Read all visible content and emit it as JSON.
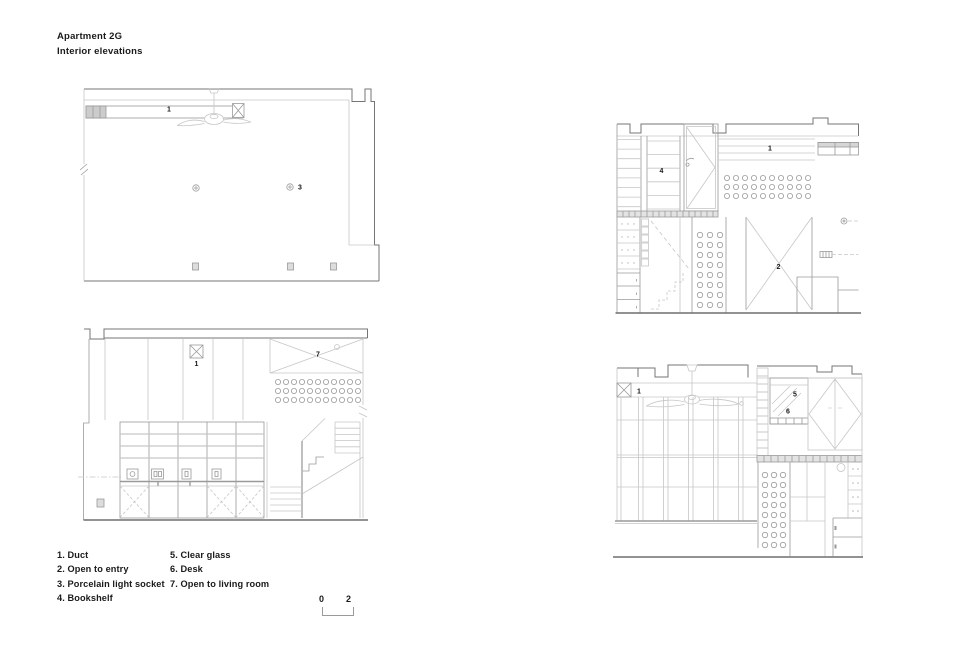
{
  "sheet": {
    "title": "Apartment 2G",
    "subtitle": "Interior elevations"
  },
  "legend": {
    "items": [
      "1. Duct",
      "2. Open to entry",
      "3. Porcelain light socket",
      "4. Bookshelf",
      "5. Clear glass",
      "6. Desk",
      "7. Open to living room"
    ]
  },
  "scale_bar": {
    "start": "0",
    "end": "2"
  },
  "drawings": {
    "top_left": {
      "labels": {
        "duct": "1",
        "light_socket": "3"
      }
    },
    "bottom_left": {
      "labels": {
        "duct": "1",
        "open_to_living_room": "7"
      }
    },
    "top_right": {
      "labels": {
        "bookshelf": "4",
        "duct": "1",
        "open_to_entry": "2"
      }
    },
    "bottom_right": {
      "labels": {
        "duct": "1",
        "clear_glass": "5",
        "desk": "6"
      }
    }
  },
  "colors": {
    "background": "#ffffff",
    "line_light": "#c6c6c6",
    "line_medium": "#9a9a9a",
    "line_dark": "#757575",
    "text": "#1a1a1a"
  }
}
